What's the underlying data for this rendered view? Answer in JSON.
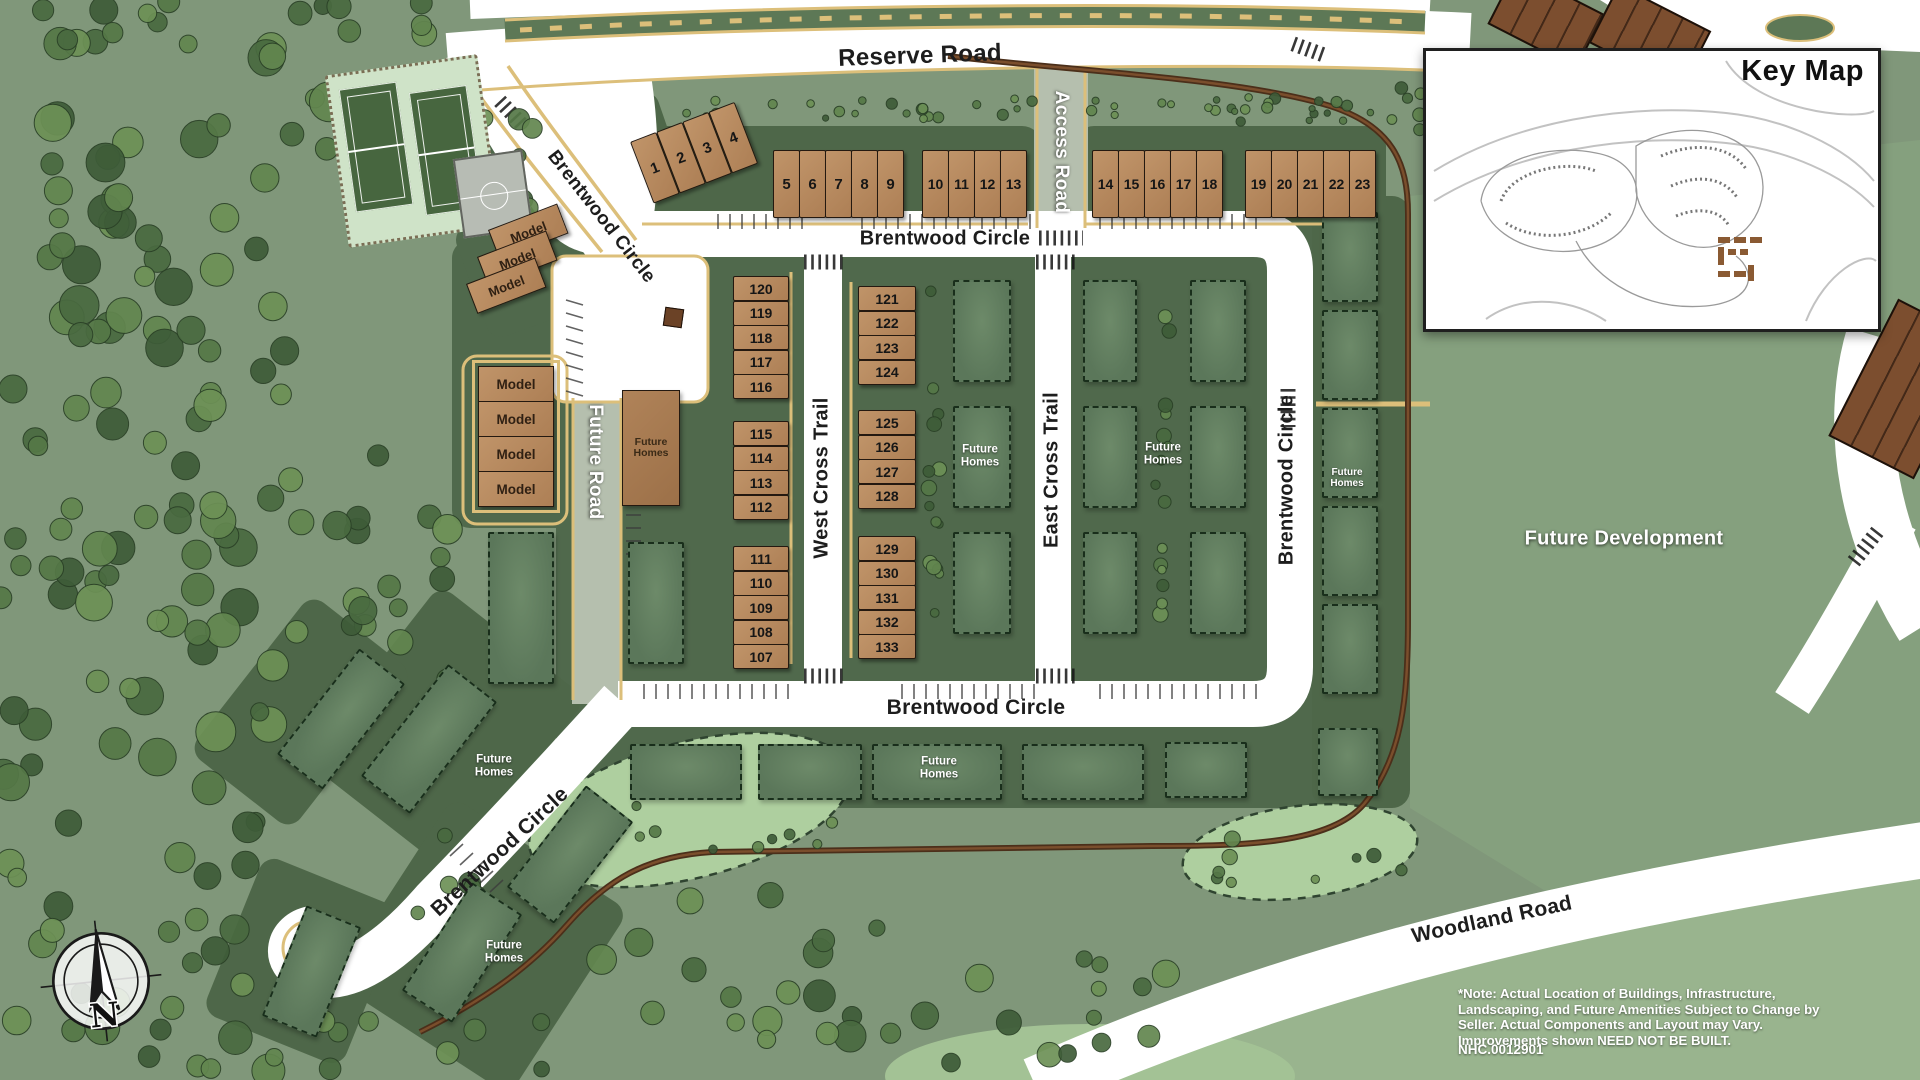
{
  "key_map": {
    "title": "Key Map"
  },
  "roads": {
    "reserve_road": "Reserve Road",
    "access_road": "Access Road",
    "brentwood_circle": "Brentwood Circle",
    "west_cross_trail": "West Cross Trail",
    "east_cross_trail": "East Cross Trail",
    "future_road": "Future Road",
    "woodland_road": "Woodland Road"
  },
  "areas": {
    "future_development": "Future Development",
    "future_homes": "Future Homes",
    "model": "Model"
  },
  "lots": {
    "row_1_4": [
      "1",
      "2",
      "3",
      "4"
    ],
    "row_5_9": [
      "5",
      "6",
      "7",
      "8",
      "9"
    ],
    "row_10_13": [
      "10",
      "11",
      "12",
      "13"
    ],
    "row_14_18": [
      "14",
      "15",
      "16",
      "17",
      "18"
    ],
    "row_19_23": [
      "19",
      "20",
      "21",
      "22",
      "23"
    ],
    "west_a": [
      "120",
      "119",
      "118",
      "117",
      "116"
    ],
    "west_b": [
      "115",
      "114",
      "113",
      "112"
    ],
    "west_c": [
      "111",
      "110",
      "109",
      "108",
      "107"
    ],
    "east_a": [
      "121",
      "122",
      "123",
      "124"
    ],
    "east_b": [
      "125",
      "126",
      "127",
      "128"
    ],
    "east_c": [
      "129",
      "130",
      "131",
      "132",
      "133"
    ]
  },
  "compass": {
    "north": "N"
  },
  "note": {
    "text": "*Note: Actual Location of Buildings, Infrastructure, Landscaping, and Future Amenities Subject to Change by Seller. Actual Components and Layout may Vary. Improvements shown NEED NOT BE BUILT.",
    "plan_number": "NHC.0012901"
  },
  "colors": {
    "base_green": "#80977a",
    "pad_green": "#4e684b",
    "road_white": "#ffffff",
    "road_gray": "#b5bfae",
    "curb_tan": "#dcbf7a",
    "unit_brown": "#b58b63",
    "ghost_green": "#5e7a5e",
    "trail_brown": "#4b2f1a"
  }
}
